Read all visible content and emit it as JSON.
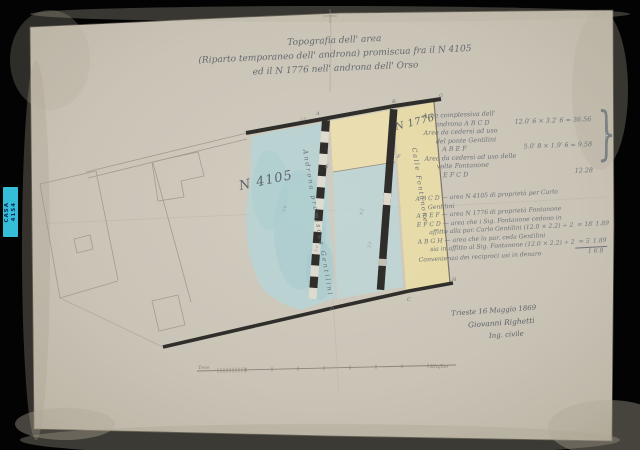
{
  "colors": {
    "background": "#030303",
    "paper": "#cdc7ba",
    "ink": "#6a6f75",
    "band_dark": "#2f2e2a",
    "wash_blue": "#b6d4d5",
    "wash_yellow": "#ecdfae",
    "archive_label_cyan": "#35bed8"
  },
  "archive_label": {
    "line1": "CASA",
    "line2": "4154"
  },
  "title": {
    "line1": "Topografia dell' area",
    "line2": "(Riparto temporaneo dell' androna) promiscua fra il N 4105",
    "line3": "ed il N 1776 nell' androna dell' Orso"
  },
  "map": {
    "parcel_left_label": "N 4105",
    "parcel_left_note": "Androna promiscua Gentilini",
    "parcel_right_label": "N 1776",
    "parcel_right_note": "Calle Fontanone",
    "corner_letters": [
      "A",
      "B",
      "C",
      "D",
      "E",
      "F",
      "G",
      "H"
    ],
    "dim_marks": [
      "2.0",
      "4.2",
      "3.1",
      "2.6",
      "5.0"
    ]
  },
  "calc1": {
    "lines": [
      {
        "t": "Area complessiva dell'",
        "v": ""
      },
      {
        "t": "androna A B C D",
        "v": "12.0′ 6 × 3.2′ 6 = 36.56"
      },
      {
        "t": "Area da cedersi ad uso",
        "v": ""
      },
      {
        "t": "del ponte Gentilini",
        "v": ""
      },
      {
        "t": "A B E F",
        "v": "5.0′ 8 × 1.9′ 6 = 9.58"
      },
      {
        "t": "Area da cedersi ad uso delle",
        "v": ""
      },
      {
        "t": "volte Fontanone",
        "v": ""
      },
      {
        "t": "E F C D",
        "v": "12.28"
      }
    ],
    "brace": "}",
    "brace_word": "misura"
  },
  "calc2": {
    "lines": [
      {
        "t": "A B C D — area N 4105 di proprietà per Carlo",
        "v": ""
      },
      {
        "t": "Gentilini",
        "v": ""
      },
      {
        "t": "A B E F — area N 1776 di proprietà Fontanone",
        "v": ""
      },
      {
        "t": "E F C D — area che i Sig. Fontanone cedono in",
        "v": ""
      },
      {
        "t": "affitto alla par. Carlo Gentilini (12.0 × 2.2) ÷ 2",
        "v": "= 18′ 1.89"
      },
      {
        "t": "A B G H — area che la par. ceda Gentilini",
        "v": ""
      },
      {
        "t": "sia in affitto al Sig. Fontanone (12.0 × 2.2) ÷ 2",
        "v": "= 5′ 1.89"
      },
      {
        "t": "Convenienza dei reciproci usi in denaro",
        "v": "1 6 8"
      }
    ]
  },
  "signature": {
    "place_date": "Trieste 16 Maggio 1869",
    "name": "Giovanni Righetti",
    "title_line": "Ing. civile"
  },
  "scale_bar": {
    "left_label": "Tese",
    "right_label": "Klafter"
  }
}
